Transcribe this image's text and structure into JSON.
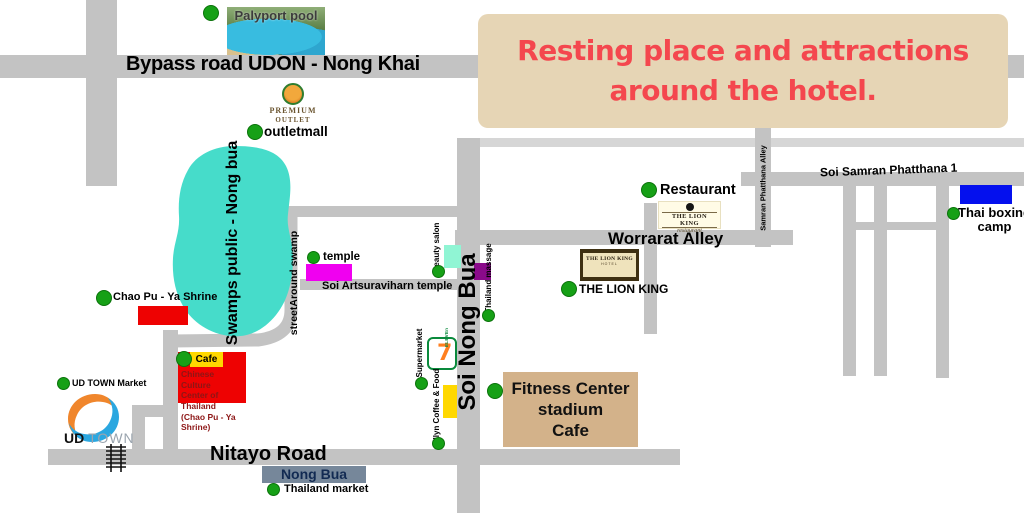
{
  "title": {
    "line1": "Resting place and attractions",
    "line2": "around the hotel."
  },
  "colors": {
    "road": "#c3c3c3",
    "road_light": "#d6d6d6",
    "swamp": "#46dcca",
    "marker_green": "#16a016",
    "title_bg": "#e6d5b5",
    "title_text": "#f4474e",
    "red_marker": "#ee0202",
    "magenta_marker": "#f000f0",
    "aqua_marker": "#90f5d4",
    "purple_marker": "#8a0a8a",
    "yellow_marker": "#ffd800",
    "blue_marker": "#0410ee",
    "tan_block": "#d3b28a",
    "slate_block": "#76879a"
  },
  "roads": {
    "bypass": "Bypass road UDON - Nong Khai",
    "soi_nong_bua": "Soi Nong Bua",
    "worrarat": "Worrarat Alley",
    "soi_samran_phatthana_1": "Soi Samran Phatthana  1",
    "samran_phatthana_alley": "Samran Phatthana Alley",
    "soi_artsuraviharn": "Soi Artsuraviharn temple",
    "street_around_swamp": "streetAround swamp",
    "nitayo": "Nitayo Road"
  },
  "areas": {
    "swamp_label": "Swamps public - Nong bua",
    "nong_bua": "Nong Bua"
  },
  "pois": {
    "palyport_pool": "Palyport pool",
    "premium": "PREMIUM",
    "outlet": "OUTLET",
    "outletmall": "outletmall",
    "restaurant": "Restaurant",
    "lion_king_restaurant_sign": {
      "name": "THE LION KING",
      "type": "restaurant"
    },
    "lion_king_hotel_sign": {
      "name": "THE LION KING",
      "type": "HOTEL"
    },
    "lion_king_hotel_label": "THE LION KING",
    "thai_boxing": {
      "line1": "Thai boxing",
      "line2": "camp"
    },
    "temple": "temple",
    "beauty_salon": "beauty salon",
    "thailand_massage": "Thailand massage",
    "chao_pu_ya_shrine": "Chao Pu - Ya Shrine",
    "cafe": "Cafe",
    "chinese_center": {
      "line1": "Chinese Culture",
      "line2": "Center of Thailand",
      "line3": "(Chao Pu - Ya Shrine)"
    },
    "ud_town_market": "UD TOWN Market",
    "ud_town": {
      "ud": "UD",
      "town": "TOWN"
    },
    "supermarket": "Supermarket",
    "seven_eleven": {
      "seven": "7",
      "eleven": "ELEVEn"
    },
    "allyn_coffee": "Allyn Coffee & Food",
    "fitness": {
      "line1": "Fitness Center",
      "line2": "stadium",
      "line3": "Cafe"
    },
    "thailand_market": "Thailand market"
  }
}
